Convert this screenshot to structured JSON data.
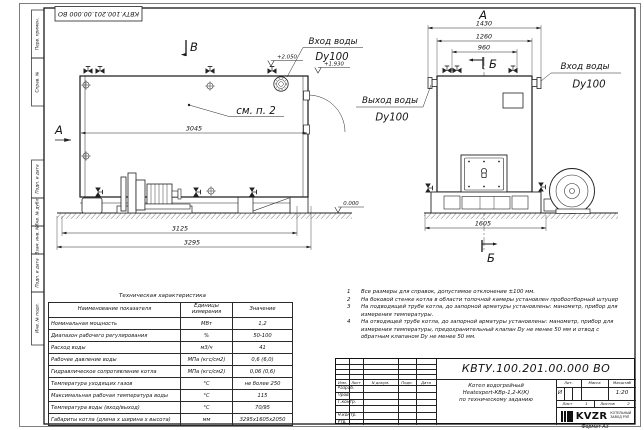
{
  "stamp_top_left": "КВТУ.100.201.00.000 ВО",
  "margin_labels": {
    "top": [
      "Перв. примен.",
      "Справ. №"
    ],
    "bottom": [
      "Подп. и дата",
      "Инв. № дубл.",
      "Взам. инв. №",
      "Подп. и дата",
      "Инв. № подл."
    ]
  },
  "side_view": {
    "section_label": "В",
    "view_arrow_label": "А",
    "see_note_label": "см. п. 2",
    "inlet_label": "Вход воды",
    "inlet_dn": "Dy100",
    "dims": {
      "width_body": "3045",
      "width_frame": "3125",
      "width_total": "3295"
    },
    "levels": {
      "top": "+2.050",
      "nozzle": "+1.930",
      "ground": "0.000"
    }
  },
  "front_view": {
    "view_label": "А",
    "section_label_top": "Б",
    "section_label_bottom": "Б",
    "outlet_label": "Выход воды",
    "outlet_dn": "Dy100",
    "inlet_label": "Вход воды",
    "inlet_dn": "Dy100",
    "dims": {
      "width_total": "1430",
      "width_body": "1260",
      "width_inner": "960",
      "base": "1605"
    }
  },
  "tech_table": {
    "title": "Техническая характеристика",
    "headers": [
      "Наименование показателя",
      "Единицы измерения",
      "Значение"
    ],
    "rows": [
      [
        "Номинальная мощность",
        "МВт",
        "1,2"
      ],
      [
        "Диапазон рабочего регулирования",
        "%",
        "50-100"
      ],
      [
        "Расход воды",
        "м3/ч",
        "41"
      ],
      [
        "Рабочее давление воды",
        "МПа (кгс/см2)",
        "0,6 (6,0)"
      ],
      [
        "Гидравлическое сопротивление котла",
        "МПа (кгс/см2)",
        "0,06 (0,6)"
      ],
      [
        "Температура уходящих газов",
        "°С",
        "не более 250"
      ],
      [
        "Максимальная рабочая температура воды",
        "°С",
        "115"
      ],
      [
        "Температура воды (вход/выход)",
        "°С",
        "70/95"
      ],
      [
        "Габариты котла (длина х ширина х высота)",
        "мм",
        "3295х1605х2050"
      ]
    ]
  },
  "notes": {
    "items": [
      {
        "num": "1",
        "text": "Все размеры для справок, допустимое отклонение ±100 мм."
      },
      {
        "num": "2",
        "text": "На боковой стенке котла в области топочной камеры установлен пробоотборный штуцер"
      },
      {
        "num": "3",
        "text": "На подводящей трубе котла, до запорной арматуры установлены: манометр, прибор для измерения температуры."
      },
      {
        "num": "4",
        "text": "На отводящей трубе котла, до запорной арматуры установлены: манометр, прибор для измерения температуры, предохранительный клапан Dу не менее 50 мм и отвод с обратным клапаном Dу не менее 50 мм."
      }
    ]
  },
  "title_block": {
    "doc_number": "КВТУ.100.201.00.000  ВО",
    "product_lines": [
      "Котел водогрейный",
      "Heatexpert-КВр-1,2-К(К)",
      "по техническому заданию"
    ],
    "rev_cols": [
      "Изм.",
      "Лист",
      "N докум.",
      "Подп.",
      "Дата"
    ],
    "roles": [
      "Разраб.",
      "Пров.",
      "Т.контр.",
      "",
      "Н.контр.",
      "Утв."
    ],
    "lit_label": "Лит.",
    "mass_label": "Масса",
    "scale_label": "Масштаб",
    "lit_value": "И",
    "scale_value": "1:20",
    "sheet_label": "Лист",
    "sheet_value": "1",
    "sheets_label": "Листов",
    "sheets_value": "2",
    "logo_text": "KVZR",
    "company_lines": [
      "КОТЕЛЬНЫЙ",
      "ЗАВОД РЭП"
    ],
    "format_label": "Формат  А3"
  }
}
